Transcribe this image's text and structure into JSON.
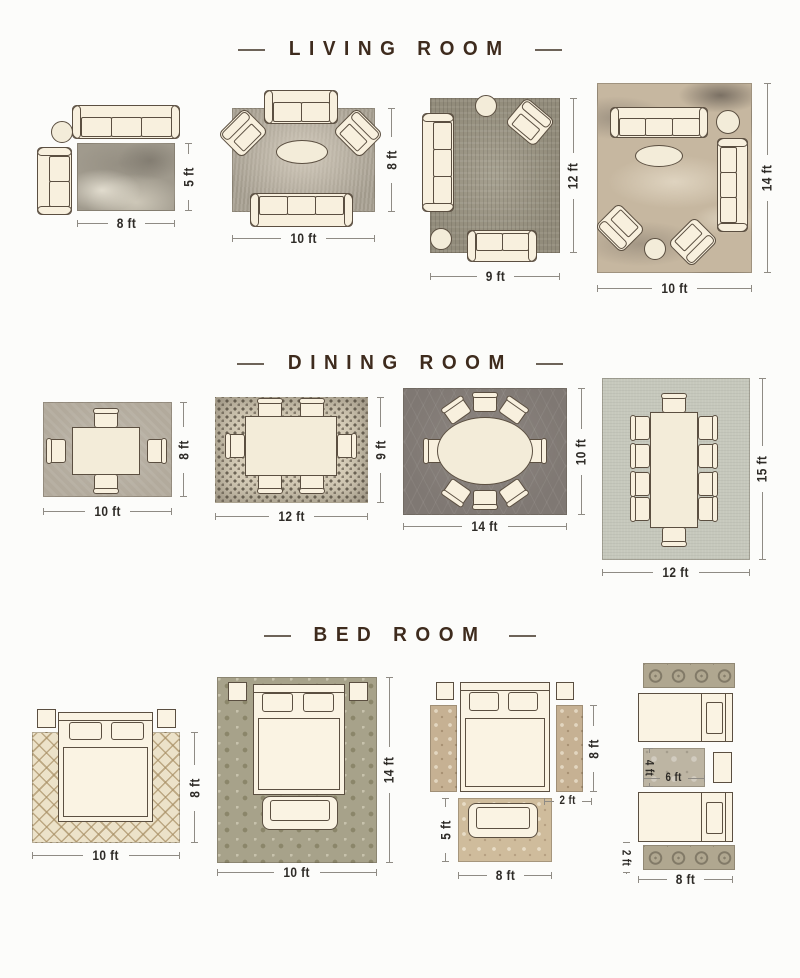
{
  "colors": {
    "title_text": "#3e2b1d",
    "dimension_text": "#2e2b27",
    "furniture_fill": "#f8f0de",
    "furniture_outline": "#5b4f41"
  },
  "sections": {
    "living": {
      "title": "LIVING ROOM",
      "layouts": [
        {
          "width": "8 ft",
          "height": "5 ft"
        },
        {
          "width": "10 ft",
          "height": "8 ft"
        },
        {
          "width": "9 ft",
          "height": "12 ft"
        },
        {
          "width": "10 ft",
          "height": "14 ft"
        }
      ]
    },
    "dining": {
      "title": "DINING ROOM",
      "layouts": [
        {
          "width": "10 ft",
          "height": "8 ft"
        },
        {
          "width": "12 ft",
          "height": "9 ft"
        },
        {
          "width": "14 ft",
          "height": "10 ft"
        },
        {
          "width": "12 ft",
          "height": "15 ft"
        }
      ]
    },
    "bedroom": {
      "title": "BED ROOM",
      "layouts": [
        {
          "width": "10 ft",
          "height": "8 ft"
        },
        {
          "width": "10 ft",
          "height": "14 ft"
        },
        {
          "height": "8 ft",
          "runner_width": "2 ft",
          "foot_height": "5 ft",
          "width": "8 ft"
        },
        {
          "mid_height": "4 ft",
          "mid_width": "6 ft",
          "runner_height": "2 ft",
          "width": "8 ft"
        }
      ]
    }
  }
}
